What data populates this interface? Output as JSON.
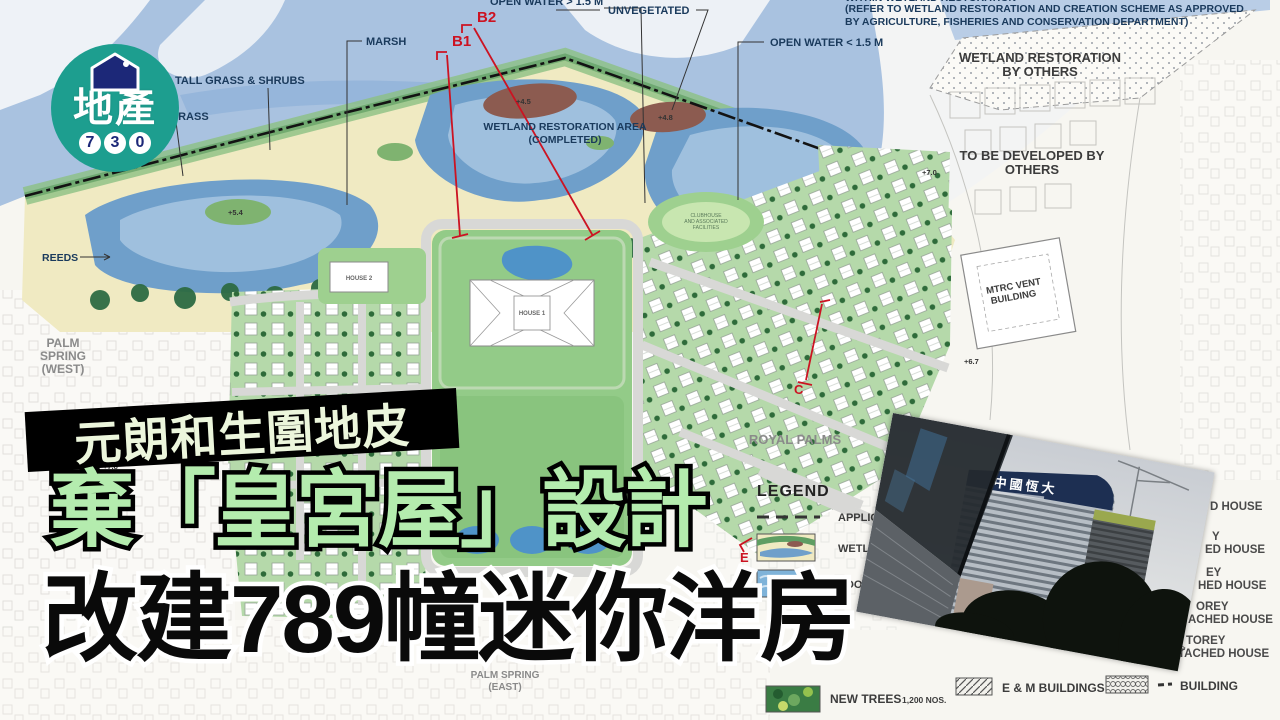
{
  "logo": {
    "name": "地產",
    "digits": [
      "7",
      "3",
      "0"
    ]
  },
  "headlines": {
    "line1": "元朗和生圍地皮",
    "line2": "棄「皇宮屋」設計",
    "line3": "改建789幢迷你洋房"
  },
  "photo": {
    "sign": "中國恆大"
  },
  "map": {
    "labels": {
      "marsh": "MARSH",
      "tall_grass": "TALL GRASS & SHRUBS",
      "short_grass": "SHORT GRASS",
      "open_water_gt": "OPEN WATER > 1.5 M",
      "unvegetated": "UNVEGETATED",
      "open_water_lt": "OPEN WATER < 1.5 M",
      "wetland_area": [
        "WETLAND RESTORATION AREA",
        "(COMPLETED)"
      ],
      "note": [
        "WITHIN WETLAND RESTORATION",
        "(REFER TO WETLAND RESTORATION AND CREATION SCHEME AS APPROVED",
        "BY AGRICULTURE, FISHERIES AND CONSERVATION DEPARTMENT)"
      ],
      "wetland_by_others": [
        "WETLAND RESTORATION",
        "BY OTHERS"
      ],
      "developed_by_others": [
        "TO BE DEVELOPED BY",
        "OTHERS"
      ],
      "mtrc": [
        "MTRC VENT",
        "BUILDING"
      ],
      "reeds": "REEDS",
      "palm_spring_west": [
        "PALM",
        "SPRING",
        "(WEST)"
      ],
      "palm_spring_east": [
        "PALM SPRING",
        "(EAST)"
      ],
      "royal_palms": "ROYAL PALMS",
      "clubhouse": [
        "CLUBHOUSE",
        "AND ASSOCIATED",
        "FACILITIES"
      ],
      "house1": "HOUSE 1",
      "house2": "HOUSE 2"
    },
    "sections": {
      "b1": "B1",
      "b2": "B2",
      "c": "C",
      "d": "D",
      "e": "E"
    },
    "elevations": {
      "e54": "+5.4",
      "e45": "+4.5",
      "e48": "+4.8",
      "e70": "+7.0",
      "e67": "+6.7",
      "e78": "+7.8"
    },
    "legend": {
      "title": "LEGEND",
      "application": "APPLICATIO",
      "wetland": "WETLAND",
      "pool": "POOL / V",
      "new_trees": "NEW TREES",
      "new_trees_qty": "1,200 NOS.",
      "em_buildings": "E & M BUILDINGS",
      "building": "BUILDING",
      "house_types": [
        [
          "D HOUSE"
        ],
        [
          "Y",
          "ED HOUSE"
        ],
        [
          "EY",
          "HED HOUSE"
        ],
        [
          "OREY",
          "ACHED HOUSE"
        ],
        [
          "TOREY",
          "TACHED HOUSE"
        ]
      ]
    }
  },
  "colors": {
    "logo_teal": "#1d9e8f",
    "logo_navy": "#1c2878",
    "headline_green": "#b4ecae",
    "banner_black": "#000000",
    "marker_red": "#cc1322",
    "water_blue": "#a9c2e0",
    "marsh_yellow": "#f0eac2",
    "lawn_green": "#93cb88",
    "label_navy": "#1a3a5c"
  }
}
